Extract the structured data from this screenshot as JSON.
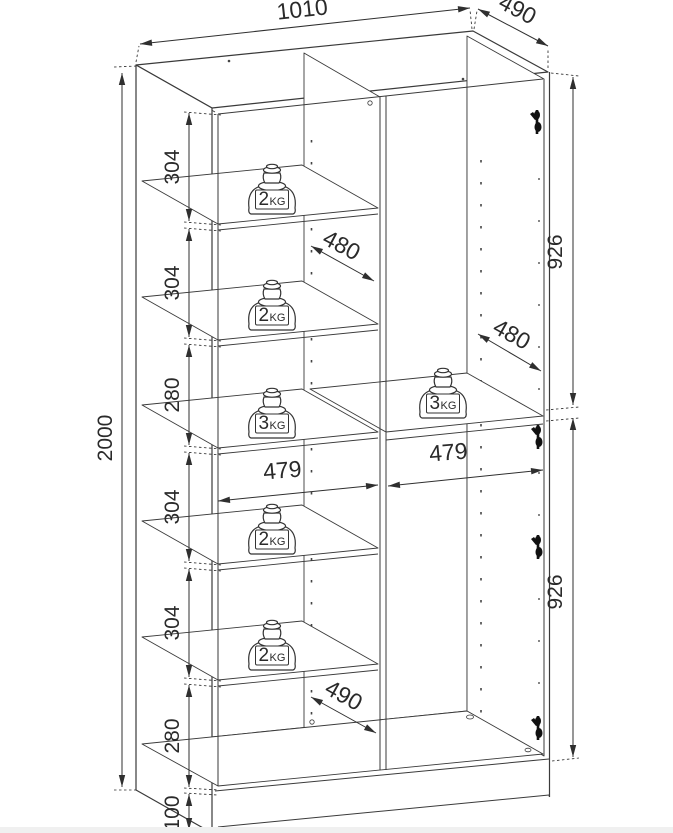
{
  "drawing": {
    "colors": {
      "line": "#3a3a3a",
      "dim": "#2a2a2a",
      "background": "#ffffff",
      "hinge": "#111111"
    },
    "dims": {
      "top_width": "1010",
      "top_depth": "490",
      "overall_height": "2000",
      "left_chain": [
        "304",
        "304",
        "280",
        "304",
        "304",
        "280",
        "100"
      ],
      "right_upper": "926",
      "right_lower": "926",
      "inner_depth_upper": "480",
      "inner_depth_right": "480",
      "inner_width_left": "479",
      "inner_width_right": "479",
      "inner_depth_bottom": "490"
    },
    "weights": {
      "shelf1": {
        "value": "2",
        "unit": "KG"
      },
      "shelf2": {
        "value": "2",
        "unit": "KG"
      },
      "shelf3": {
        "value": "3",
        "unit": "KG"
      },
      "shelf4": {
        "value": "2",
        "unit": "KG"
      },
      "shelf5": {
        "value": "2",
        "unit": "KG"
      },
      "right_shelf": {
        "value": "3",
        "unit": "KG"
      }
    }
  }
}
